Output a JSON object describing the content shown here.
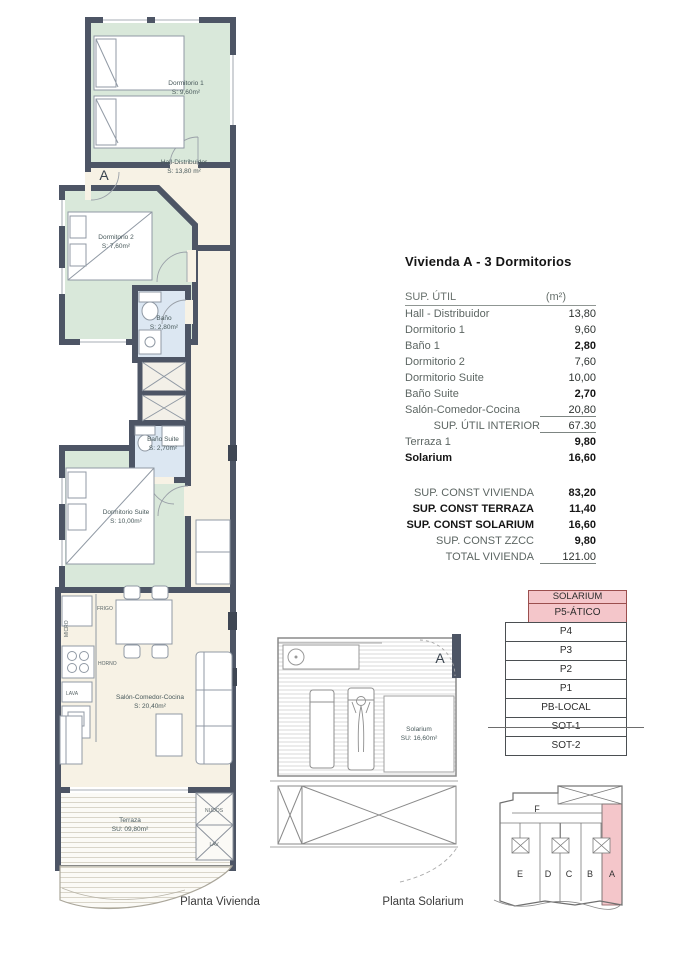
{
  "title": "Vivienda A - 3 Dormitorios",
  "sup_util": {
    "header_label": "SUP. ÚTIL",
    "header_unit": "(m²)",
    "rows": [
      {
        "label": "Hall - Distribuidor",
        "value": "13,80"
      },
      {
        "label": "Dormitorio 1",
        "value": "9,60"
      },
      {
        "label": "Baño 1",
        "value": "2,80"
      },
      {
        "label": "Dormitorio 2",
        "value": "7,60"
      },
      {
        "label": "Dormitorio Suite",
        "value": "10,00"
      },
      {
        "label": "Baño Suite",
        "value": "2,70"
      },
      {
        "label": "Salón-Comedor-Cocina",
        "value": "20,80"
      },
      {
        "label": "SUP. ÚTIL INTERIOR",
        "value": "67.30"
      },
      {
        "label": "Terraza 1",
        "value": "9,80"
      },
      {
        "label": "Solarium",
        "value": "16,60"
      }
    ]
  },
  "sup_const": {
    "rows": [
      {
        "label": "SUP. CONST VIVIENDA",
        "value": "83,20"
      },
      {
        "label": "SUP. CONST TERRAZA",
        "value": "11,40"
      },
      {
        "label": "SUP. CONST SOLARIUM",
        "value": "16,60"
      },
      {
        "label": "SUP. CONST ZZCC",
        "value": "9,80"
      },
      {
        "label": "TOTAL VIVIENDA",
        "value": "121.00"
      }
    ]
  },
  "levels": [
    {
      "label": "SOLARIUM",
      "highlight": true
    },
    {
      "label": "P5-ÁTICO",
      "highlight": true
    },
    {
      "label": "P4"
    },
    {
      "label": "P3"
    },
    {
      "label": "P2"
    },
    {
      "label": "P1"
    },
    {
      "label": "PB-LOCAL"
    },
    {
      "label": "SOT-1"
    },
    {
      "label": "SOT-2"
    }
  ],
  "keyplan": {
    "top_unit": "F",
    "units": [
      "E",
      "D",
      "C",
      "B",
      "A"
    ],
    "highlighted_unit": "A"
  },
  "plan_vivienda": {
    "caption": "Planta Vivienda",
    "entrance_marker": "A",
    "rooms": {
      "dormitorio1": {
        "name": "Dormitorio 1",
        "area": "S: 9,60m²"
      },
      "hall": {
        "name": "Hall-Distribuidor",
        "area": "S: 13,80 m²"
      },
      "dormitorio2": {
        "name": "Dormitorio 2",
        "area": "S: 7,60m²"
      },
      "bano1": {
        "name": "Baño",
        "area": "S: 2,80m²"
      },
      "bano_suite": {
        "name": "Baño Suite",
        "area": "S: 2,70m²"
      },
      "dormitorio_suite": {
        "name": "Dormitorio Suite",
        "area": "S: 10,00m²"
      },
      "salon": {
        "name": "Salón-Comedor-Cocina",
        "area": "S: 20,40m²"
      },
      "terraza": {
        "name": "Terraza",
        "area": "SU: 09,80m²"
      }
    },
    "kitchen": {
      "frigo": "FRIGO",
      "micro": "MICRO",
      "horno": "HORNO",
      "lava": "LAVA"
    },
    "utility": {
      "nudos": "NUDOS",
      "lav": "LAV"
    }
  },
  "plan_solarium": {
    "caption": "Planta Solarium",
    "marker": "A",
    "room": {
      "name": "Solarium",
      "area": "SU: 16,60m²"
    }
  },
  "colors": {
    "highlight_pink": "#f4c6ca",
    "wall_dark": "#4d5565",
    "bedroom_green": "#d9e8da",
    "bath_blue": "#dce7f2",
    "floor_cream": "#f7f2e5"
  }
}
